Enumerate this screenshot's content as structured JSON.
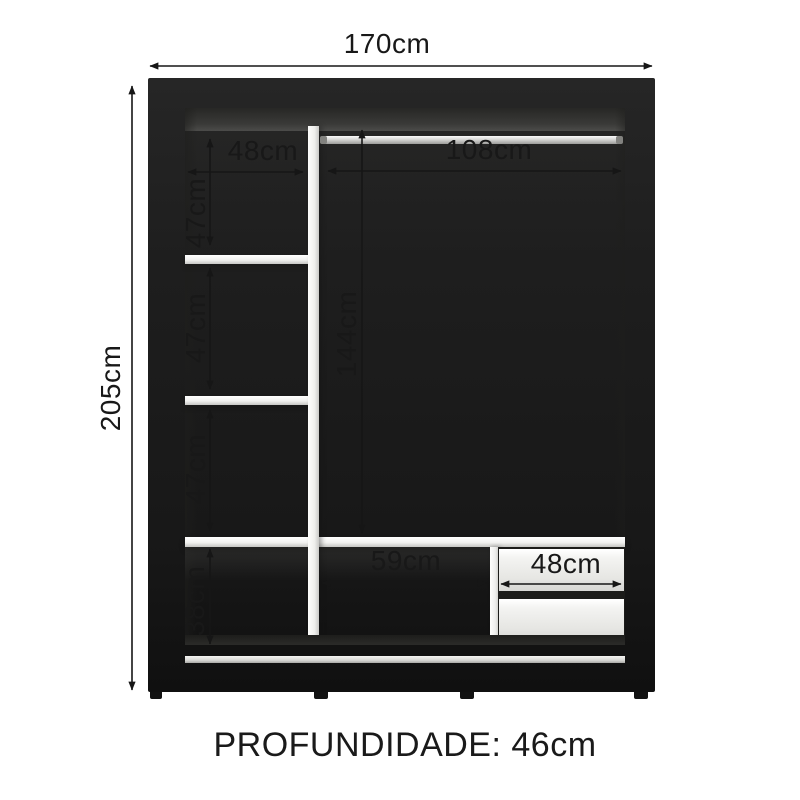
{
  "wardrobe": {
    "depth_caption": "PROFUNDIDADE: 46cm",
    "dims": {
      "overall_width": "170cm",
      "overall_height": "205cm",
      "left_column_width": "48cm",
      "left_section1_height": "47cm",
      "left_section2_height": "47cm",
      "left_section3_height": "47cm",
      "left_bottom_height": "38cm",
      "rod_section_width": "108cm",
      "hanging_height": "144cm",
      "bottom_shelf_width": "59cm",
      "drawer_width": "48cm"
    }
  }
}
